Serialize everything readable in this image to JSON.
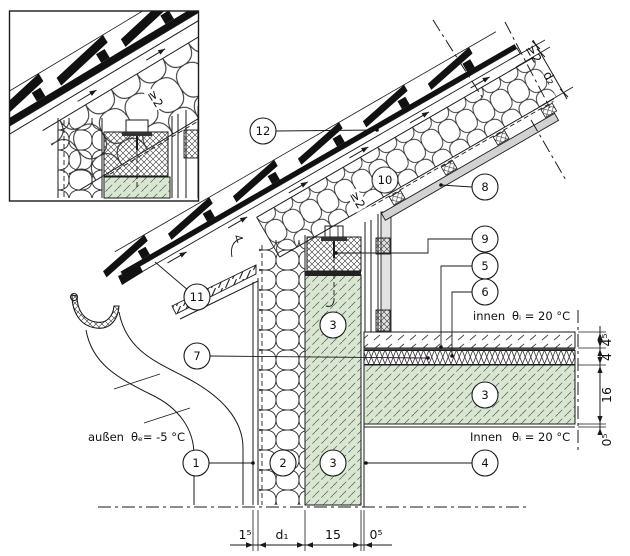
{
  "drawing": {
    "type": "construction-detail-section-eave",
    "texts": {
      "outside_zone": "außen",
      "outside_temp": "θₑ=  -5 °C",
      "inside_upper_zone": "innen",
      "inside_upper_temp": "θᵢ =  20 °C",
      "inside_lower_zone": "Innen",
      "inside_lower_temp": "θᵢ =  20 °C",
      "roof_vent_gap": "≥2",
      "inset_vent_gap": "≥2"
    },
    "dims": {
      "bottom": [
        "1⁵",
        "d₁",
        "15",
        "0⁵"
      ],
      "right": [
        "4⁵",
        "4",
        "16",
        "0⁵"
      ],
      "roof": [
        "≥2",
        "d₂"
      ]
    },
    "callouts": {
      "c1": "1",
      "c2": "2",
      "c3": "3",
      "c4": "4",
      "c5": "5",
      "c6": "6",
      "c7": "7",
      "c8": "8",
      "c9": "9",
      "c10": "10",
      "c11": "11",
      "c12": "12"
    },
    "colors": {
      "masonry_green": "#d9e7d2",
      "cladding_gray": "#d2d2d2",
      "line": "#1a1a1a"
    }
  }
}
